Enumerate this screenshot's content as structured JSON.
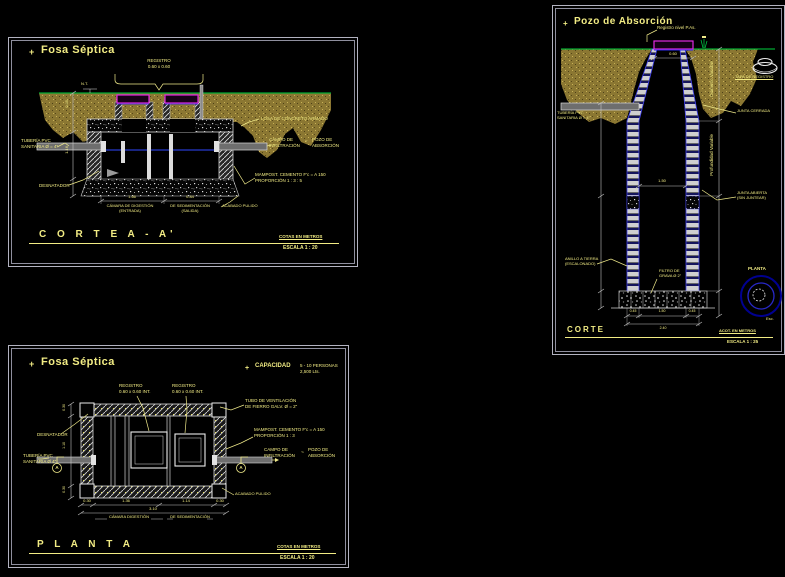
{
  "colors": {
    "text_yellow": "#f2ec84",
    "lid_magenta": "#e22ae2",
    "ground_green": "#00a832",
    "water_blue": "#3048ff",
    "joint_blue": "#4444ee",
    "sand_olive": "#8b7732",
    "plan_navy": "#000090",
    "dim_gray": "#c4c4c4"
  },
  "corte": {
    "marker": "+",
    "title": "Fosa Séptica",
    "registro_l1": "REGISTRO",
    "registro_l2": "0.60 x 0.60",
    "nt": "N.T.",
    "losa": "LOSA DE CONCRETO ARMADO",
    "campo_l1": "CAMPO DE",
    "campo_l2": "INFILTRACIÓN",
    "tilde": "~",
    "pozo_l1": "POZO DE",
    "pozo_l2": "ABSORCIÓN",
    "mamp_l1": "MAMPOST. CEMENTO F'c = A 150",
    "mamp_l2": "PROPORCIÓN  1 : 3 : 5",
    "acabado": "ACABADO PULIDO",
    "tuberia_l1": "TUBERÍA PVC",
    "tuberia_l2": "SANITARIA Ø = 4\"",
    "desnatador": "DESNATADOR",
    "cam_izq_l1": "CÁMARA DE DIGESTIÓN",
    "cam_izq_l2": "(ENTRADA)",
    "cam_der_l1": "DE SEDIMENTACIÓN",
    "cam_der_l2": "(SALIDA)",
    "dim_w1": "1.66",
    "dim_w2": "0.84",
    "dim_h1": "0.45",
    "dim_h2": "1.16",
    "section_title": "C O R T E    A - A'",
    "note_cotas": "COTAS EN METROS",
    "note_escala": "ESCALA  1 : 20"
  },
  "planta": {
    "marker": "+",
    "title": "Fosa Séptica",
    "cap_marker": "+",
    "cap_label": "CAPACIDAD",
    "cap_l1": "5 - 10 PERSONAS",
    "cap_l2": "2,500 Lts.",
    "reg1_l1": "REGISTRO",
    "reg1_l2": "0.60 x 0.60 INT.",
    "reg2_l1": "REGISTRO",
    "reg2_l2": "0.60 x 0.60 INT.",
    "vent_l1": "TUBO DE VENTILACIÓN",
    "vent_l2": "DE FIERRO GALV. Ø = 2\"",
    "mamp_l1": "MAMPOST. CEMENTO F'c = A 150",
    "mamp_l2": "PROPORCIÓN  1 : 3",
    "campo_l1": "CAMPO DE",
    "campo_l2": "INFILTRACIÓN",
    "tilde": "~",
    "pozo_l1": "POZO DE",
    "pozo_l2": "ABSORCIÓN",
    "acabado": "ACABADO PULIDO",
    "desnatador": "DESNATADOR",
    "tuberia_l1": "TUBERÍA PVC",
    "tuberia_l2": "SANITARIA Ø 4\"",
    "cut_letter_left": "A",
    "cut_letter_right": "A",
    "cam_izq": "CÁMARA DIGESTIÓN",
    "cam_der": "DE SEDIMENTACIÓN",
    "dim_b1": "0.30",
    "dim_b2": "1.36",
    "dim_b3": "1.14",
    "dim_b4": "0.30",
    "dim_btotal": "3.10",
    "dim_l1": "0.30",
    "dim_l2": "1.10",
    "dim_l3": "0.30",
    "section_title": "P L A N T A",
    "note_cotas": "COTAS EN METROS",
    "note_escala": "ESCALA  1 : 20"
  },
  "pozo": {
    "marker": "+",
    "title": "Pozo de Absorción",
    "registro": "Registro nivel P.As.",
    "tuberia_l1": "TUBERÍA PVC",
    "tuberia_l2": "SANITARIA Ø = 4\"",
    "tapa": "TAPA DE REGISTRO",
    "junta_c": "JUNTA CERRADA",
    "junta_a_l1": "JUNTA ABIERTA",
    "junta_a_l2": "(SIN JUNTEAR)",
    "diam_var": "Diámetro Variable",
    "prof_var": "Profundidad Variable",
    "anillo_l1": "ANILLO A TIERRA",
    "anillo_l2": "(ESCALONADO)",
    "filtro_l1": "FILTRO DE",
    "filtro_l2": "GRAVA Ø 2\"",
    "plan_lbl": "PLANTA",
    "esc_lbl": "Esc.",
    "dim_neck": "0.60",
    "dim_inner": "1.50",
    "dim_b1": "0.45",
    "dim_b2": "1.50",
    "dim_b3": "0.45",
    "dim_btotal": "2.40",
    "section_title": "CORTE",
    "note_acot": "ACOT. EN METROS",
    "note_escala": "ESCALA  1 : 25"
  }
}
